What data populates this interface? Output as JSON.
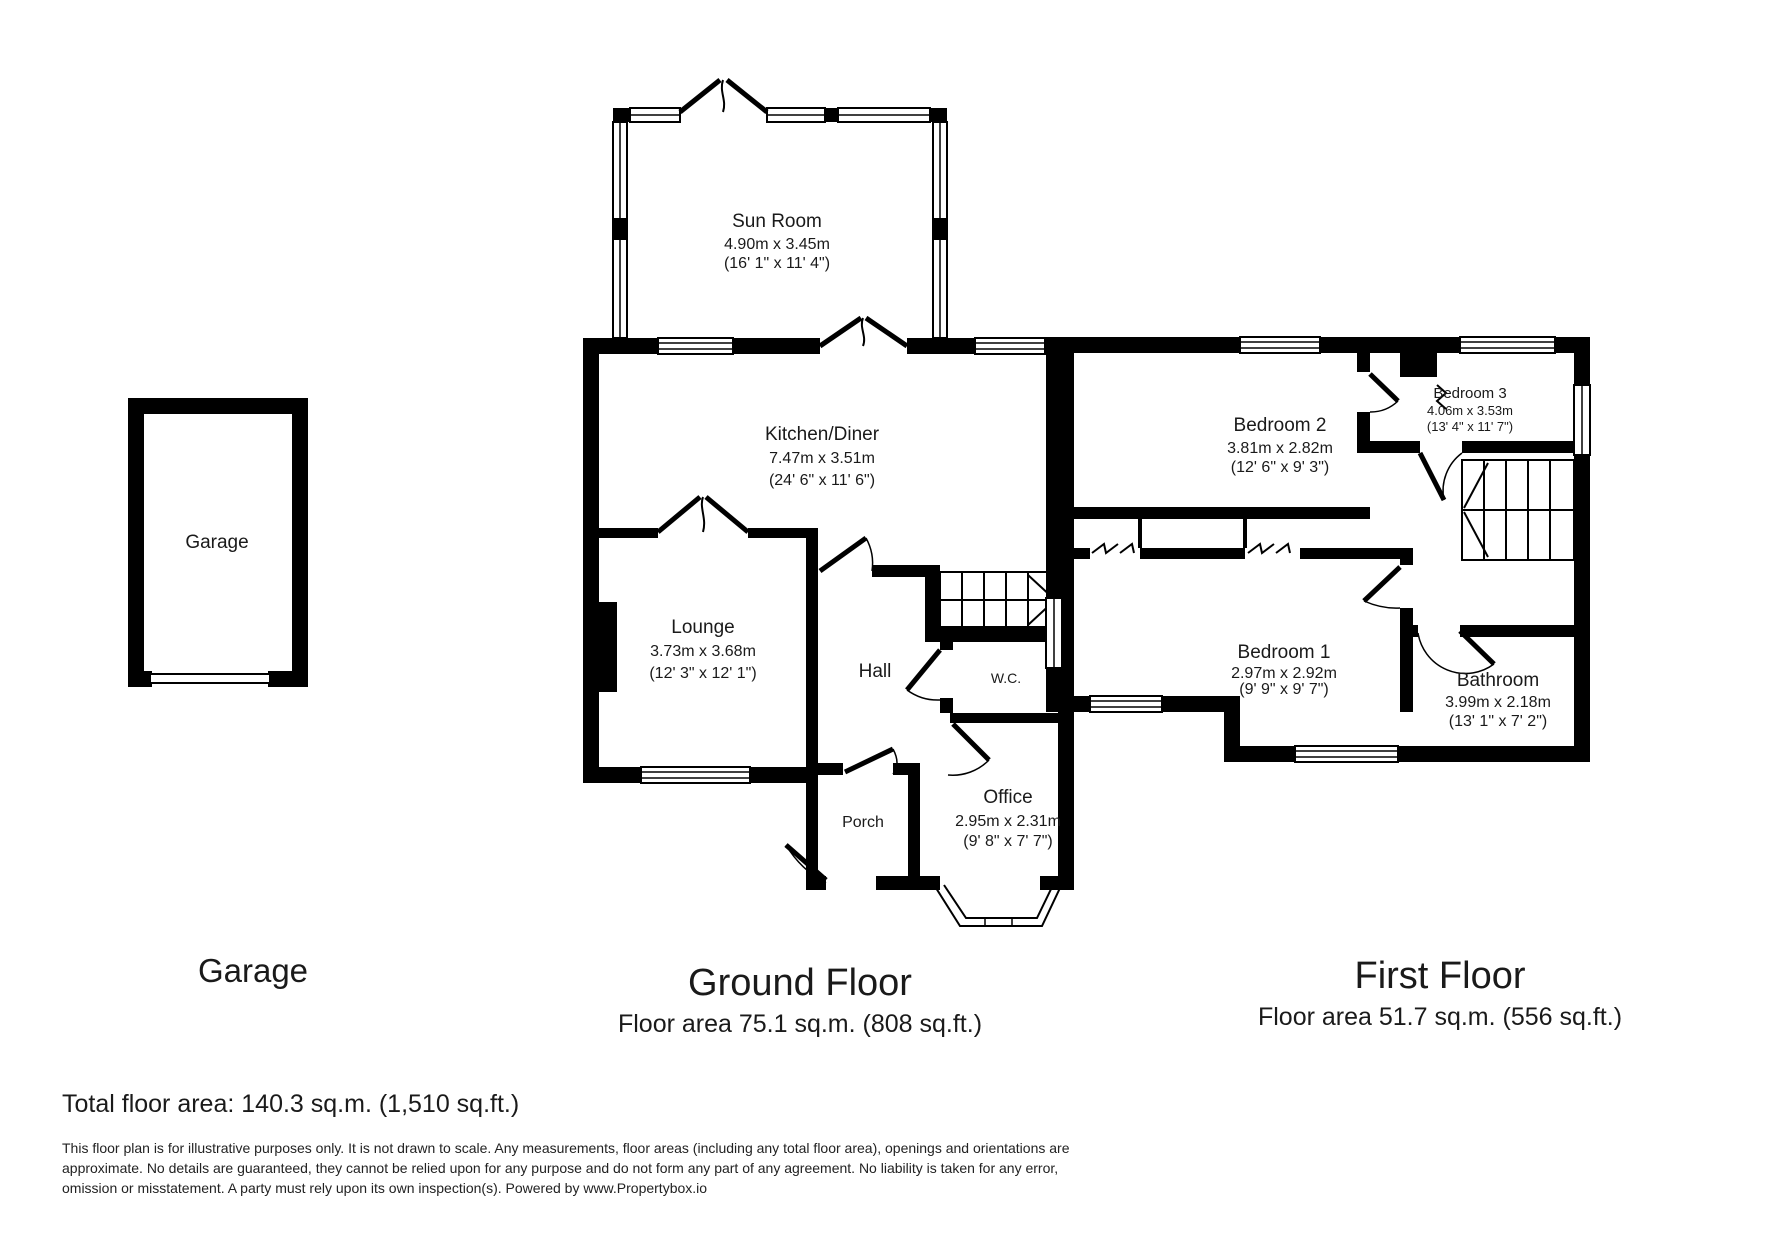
{
  "garage": {
    "room_label": "Garage",
    "title": "Garage"
  },
  "ground_floor": {
    "title": "Ground Floor",
    "floor_area": "Floor area 75.1 sq.m. (808 sq.ft.)",
    "rooms": {
      "sun_room": {
        "name": "Sun Room",
        "metric": "4.90m x 3.45m",
        "imperial": "(16' 1\" x 11' 4\")"
      },
      "kitchen_diner": {
        "name": "Kitchen/Diner",
        "metric": "7.47m x 3.51m",
        "imperial": "(24' 6\" x 11' 6\")"
      },
      "lounge": {
        "name": "Lounge",
        "metric": "3.73m x 3.68m",
        "imperial": "(12' 3\" x 12' 1\")"
      },
      "hall": {
        "name": "Hall"
      },
      "wc": {
        "name": "W.C."
      },
      "office": {
        "name": "Office",
        "metric": "2.95m x 2.31m",
        "imperial": "(9' 8\" x 7' 7\")"
      },
      "porch": {
        "name": "Porch"
      }
    }
  },
  "first_floor": {
    "title": "First Floor",
    "floor_area": "Floor area 51.7 sq.m. (556 sq.ft.)",
    "rooms": {
      "bedroom2": {
        "name": "Bedroom 2",
        "metric": "3.81m x 2.82m",
        "imperial": "(12' 6\" x 9' 3\")"
      },
      "bedroom3": {
        "name": "Bedroom 3",
        "metric": "4.06m x 3.53m",
        "imperial": "(13' 4\" x 11' 7\")"
      },
      "bedroom1": {
        "name": "Bedroom 1",
        "metric": "2.97m x 2.92m",
        "imperial": "(9' 9\" x 9' 7\")"
      },
      "bathroom": {
        "name": "Bathroom",
        "metric": "3.99m x 2.18m",
        "imperial": "(13' 1\" x 7' 2\")"
      }
    }
  },
  "total_line": "Total floor area: 140.3 sq.m. (1,510 sq.ft.)",
  "disclaimer": {
    "line1": "This floor plan is for illustrative purposes only. It is not drawn to scale. Any measurements, floor areas (including any total floor area), openings and orientations are",
    "line2": "approximate. No details are guaranteed, they cannot be relied upon for any purpose and do not form any part of any agreement. No liability is taken for any error,",
    "line3": "omission or misstatement. A party must rely upon its own inspection(s). Powered by www.Propertybox.io"
  }
}
